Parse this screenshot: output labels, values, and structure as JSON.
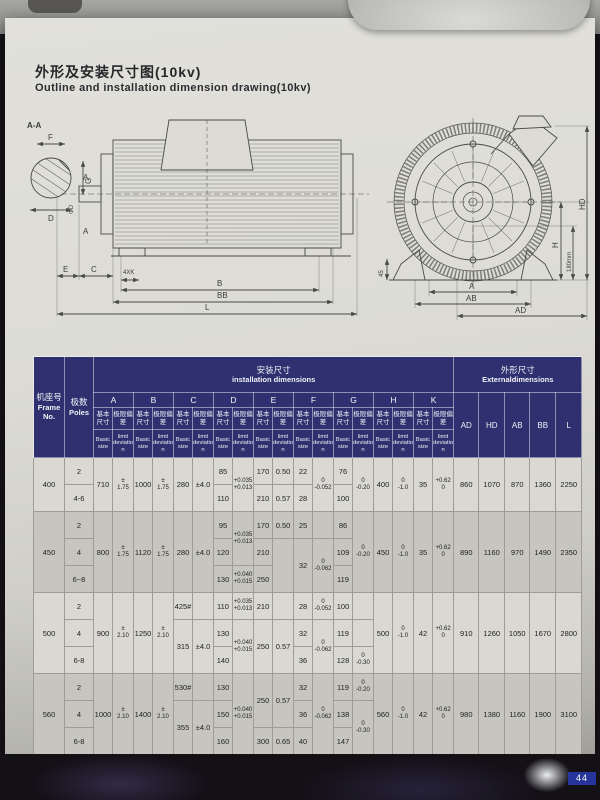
{
  "page": {
    "title_cn": "外形及安装尺寸图(10kv)",
    "title_en": "Outline and installation dimension drawing(10kv)",
    "note_cn": "注: #为采用滑动轴承电动机的C尺寸，极限偏差不包括轴向窜动量。",
    "note_en": "Note: # is the C size of the motor with sliding bearing, the limit deviation does not include the axial yaw.",
    "page_number": "44"
  },
  "drawing": {
    "section_label": "A-A",
    "shaft": {
      "f": "F",
      "g": "G",
      "d": "D"
    },
    "side": {
      "a_top": "A",
      "a_bottom": "A",
      "phi_d": "ΦD",
      "e": "E",
      "c": "C",
      "k4": "4XK",
      "b": "B",
      "bb": "BB",
      "l": "L"
    },
    "end": {
      "d45": "45",
      "a": "A",
      "ab": "AB",
      "ad": "AD",
      "h": "H",
      "h180": "180mm",
      "hd": "HD"
    }
  },
  "table": {
    "colors": {
      "header_bg": "#2e3070",
      "header_text": "#f1f1f6",
      "shade_row": "#c6c5bf"
    },
    "header": {
      "frame": {
        "cn": "机座号",
        "en": "Frame No."
      },
      "poles": {
        "cn": "极数",
        "en": "Poles"
      },
      "install": {
        "cn": "安装尺寸",
        "en": "installation dimensions"
      },
      "external": {
        "cn": "外形尺寸",
        "en": "Externaldimensions"
      },
      "dims": [
        "A",
        "B",
        "C",
        "D",
        "E",
        "F",
        "G",
        "H",
        "K"
      ],
      "basic": {
        "cn": "基本尺寸",
        "en": "Basic size"
      },
      "limit": {
        "cn": "极限偏差",
        "en": "limit deviation"
      },
      "ext_dims": [
        "AD",
        "HD",
        "AB",
        "BB",
        "L"
      ]
    },
    "groups": [
      {
        "shade": false,
        "rows": [
          [
            {
              "t": "400",
              "rs": 2
            },
            {
              "t": "2"
            },
            {
              "t": "710",
              "rs": 2
            },
            {
              "t": "±\n1.75",
              "rs": 2,
              "c": "st"
            },
            {
              "t": "1000",
              "rs": 2
            },
            {
              "t": "±\n1.75",
              "rs": 2,
              "c": "st"
            },
            {
              "t": "280",
              "rs": 2
            },
            {
              "t": "±4.0",
              "rs": 2
            },
            {
              "t": "85"
            },
            {
              "t": "+0.035\n+0.013",
              "rs": 2,
              "c": "st"
            },
            {
              "t": "170"
            },
            {
              "t": "0.50"
            },
            {
              "t": "22"
            },
            {
              "t": "0\n-0.052",
              "rs": 2,
              "c": "st"
            },
            {
              "t": "76"
            },
            {
              "t": "0\n-0.20",
              "rs": 2,
              "c": "st"
            },
            {
              "t": "400",
              "rs": 2
            },
            {
              "t": "0\n-1.0",
              "rs": 2,
              "c": "st"
            },
            {
              "t": "35",
              "rs": 2
            },
            {
              "t": "+0.62\n0",
              "rs": 2,
              "c": "st"
            },
            {
              "t": "860",
              "rs": 2
            },
            {
              "t": "1070",
              "rs": 2
            },
            {
              "t": "870",
              "rs": 2
            },
            {
              "t": "1360",
              "rs": 2
            },
            {
              "t": "2250",
              "rs": 2
            }
          ],
          [
            {
              "t": "4-6"
            },
            {
              "t": "110"
            },
            {
              "t": "210"
            },
            {
              "t": "0.57"
            },
            {
              "t": "28"
            },
            {
              "t": "100"
            }
          ]
        ]
      },
      {
        "shade": true,
        "rows": [
          [
            {
              "t": "450",
              "rs": 3
            },
            {
              "t": "2"
            },
            {
              "t": "800",
              "rs": 3
            },
            {
              "t": "±\n1.75",
              "rs": 3,
              "c": "st"
            },
            {
              "t": "1120",
              "rs": 3
            },
            {
              "t": "±\n1.75",
              "rs": 3,
              "c": "st"
            },
            {
              "t": "280",
              "rs": 3
            },
            {
              "t": "±4.0",
              "rs": 3
            },
            {
              "t": "95"
            },
            {
              "t": "+0.035\n+0.013",
              "rs": 2,
              "c": "st"
            },
            {
              "t": "170"
            },
            {
              "t": "0.50"
            },
            {
              "t": "25"
            },
            {
              "t": ""
            },
            {
              "t": "86"
            },
            {
              "t": "0\n-0.20",
              "rs": 3,
              "c": "st"
            },
            {
              "t": "450",
              "rs": 3
            },
            {
              "t": "0\n-1.0",
              "rs": 3,
              "c": "st"
            },
            {
              "t": "35",
              "rs": 3
            },
            {
              "t": "+0.62\n0",
              "rs": 3,
              "c": "st"
            },
            {
              "t": "890",
              "rs": 3
            },
            {
              "t": "1160",
              "rs": 3
            },
            {
              "t": "970",
              "rs": 3
            },
            {
              "t": "1490",
              "rs": 3
            },
            {
              "t": "2350",
              "rs": 3
            }
          ],
          [
            {
              "t": "4"
            },
            {
              "t": "120"
            },
            {
              "t": "210"
            },
            {
              "t": "",
              "rs": 2
            },
            {
              "t": "32",
              "rs": 2
            },
            {
              "t": "0\n-0.062",
              "rs": 2,
              "c": "st"
            },
            {
              "t": "109"
            }
          ],
          [
            {
              "t": "6~8"
            },
            {
              "t": "130"
            },
            {
              "t": "+0.040\n+0.015",
              "c": "st"
            },
            {
              "t": "250"
            },
            {
              "t": "119"
            }
          ]
        ]
      },
      {
        "shade": false,
        "rows": [
          [
            {
              "t": "500",
              "rs": 3
            },
            {
              "t": "2"
            },
            {
              "t": "900",
              "rs": 3
            },
            {
              "t": "±\n2.10",
              "rs": 3,
              "c": "st"
            },
            {
              "t": "1250",
              "rs": 3
            },
            {
              "t": "±\n2.10",
              "rs": 3,
              "c": "st"
            },
            {
              "t": "425#"
            },
            {
              "t": ""
            },
            {
              "t": "110"
            },
            {
              "t": "+0.035\n+0.013",
              "c": "st"
            },
            {
              "t": "210"
            },
            {
              "t": ""
            },
            {
              "t": "28"
            },
            {
              "t": "0\n-0.052",
              "c": "st"
            },
            {
              "t": "100"
            },
            {
              "t": ""
            },
            {
              "t": "500",
              "rs": 3
            },
            {
              "t": "0\n-1.0",
              "rs": 3,
              "c": "st"
            },
            {
              "t": "42",
              "rs": 3
            },
            {
              "t": "+0.62\n0",
              "rs": 3,
              "c": "st"
            },
            {
              "t": "910",
              "rs": 3
            },
            {
              "t": "1260",
              "rs": 3
            },
            {
              "t": "1050",
              "rs": 3
            },
            {
              "t": "1670",
              "rs": 3
            },
            {
              "t": "2800",
              "rs": 3
            }
          ],
          [
            {
              "t": "4"
            },
            {
              "t": "315",
              "rs": 2
            },
            {
              "t": "±4.0",
              "rs": 2
            },
            {
              "t": "130"
            },
            {
              "t": "+0.040\n+0.015",
              "rs": 2,
              "c": "st"
            },
            {
              "t": "250",
              "rs": 2
            },
            {
              "t": "0.57",
              "rs": 2
            },
            {
              "t": "32"
            },
            {
              "t": "0\n-0.062",
              "rs": 2,
              "c": "st"
            },
            {
              "t": "119"
            },
            {
              "t": ""
            }
          ],
          [
            {
              "t": "6-8"
            },
            {
              "t": "140"
            },
            {
              "t": "36"
            },
            {
              "t": "128"
            },
            {
              "t": "0\n-0.30",
              "c": "st"
            }
          ]
        ]
      },
      {
        "shade": true,
        "rows": [
          [
            {
              "t": "560",
              "rs": 3
            },
            {
              "t": "2"
            },
            {
              "t": "1000",
              "rs": 3
            },
            {
              "t": "±\n2.10",
              "rs": 3,
              "c": "st"
            },
            {
              "t": "1400",
              "rs": 3
            },
            {
              "t": "±\n2.10",
              "rs": 3,
              "c": "st"
            },
            {
              "t": "530#"
            },
            {
              "t": ""
            },
            {
              "t": "130"
            },
            {
              "t": "+0.040\n+0.015",
              "rs": 3,
              "c": "st"
            },
            {
              "t": "250",
              "rs": 2
            },
            {
              "t": "0.57",
              "rs": 2
            },
            {
              "t": "32"
            },
            {
              "t": "0\n-0.062",
              "rs": 3,
              "c": "st"
            },
            {
              "t": "119"
            },
            {
              "t": "0\n-0.20",
              "c": "st"
            },
            {
              "t": "560",
              "rs": 3
            },
            {
              "t": "0\n-1.0",
              "rs": 3,
              "c": "st"
            },
            {
              "t": "42",
              "rs": 3
            },
            {
              "t": "+0.62\n0",
              "rs": 3,
              "c": "st"
            },
            {
              "t": "980",
              "rs": 3
            },
            {
              "t": "1380",
              "rs": 3
            },
            {
              "t": "1160",
              "rs": 3
            },
            {
              "t": "1900",
              "rs": 3
            },
            {
              "t": "3100",
              "rs": 3
            }
          ],
          [
            {
              "t": "4"
            },
            {
              "t": "355",
              "rs": 2
            },
            {
              "t": "±4.0",
              "rs": 2
            },
            {
              "t": "150"
            },
            {
              "t": "36"
            },
            {
              "t": "138"
            },
            {
              "t": "0\n-0.30",
              "rs": 2,
              "c": "st"
            }
          ],
          [
            {
              "t": "6-8"
            },
            {
              "t": "160"
            },
            {
              "t": "300"
            },
            {
              "t": "0.65"
            },
            {
              "t": "40"
            },
            {
              "t": "147"
            }
          ]
        ]
      }
    ]
  }
}
